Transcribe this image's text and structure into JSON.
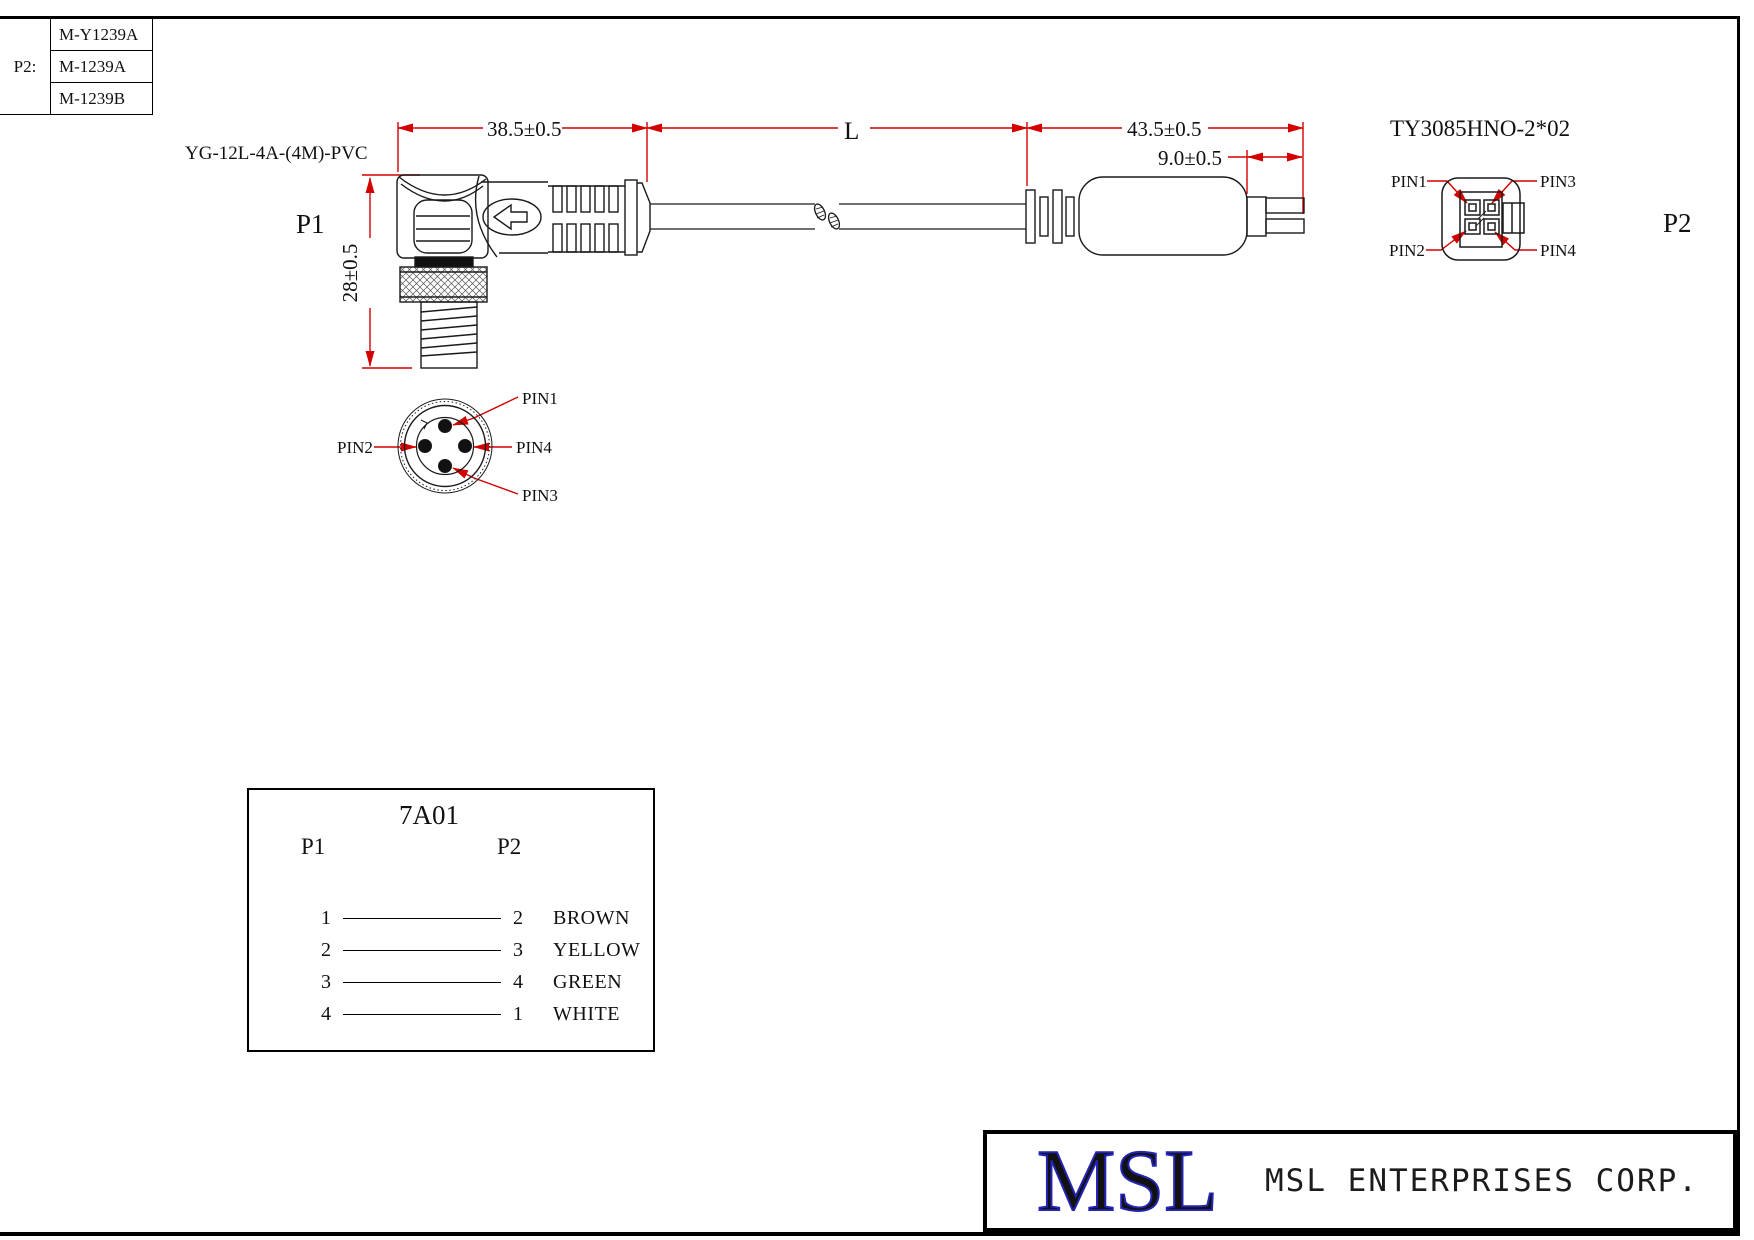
{
  "colors": {
    "line": "#1a1a1a",
    "dimension_red": "#d40000",
    "logo_blue": "#2323b4"
  },
  "variants_table": {
    "row_label": "P2:",
    "models": [
      {
        "name": "M-Y1239A"
      },
      {
        "name": "M-1239A"
      },
      {
        "name": "M-1239B"
      }
    ]
  },
  "drawing": {
    "cable_label": "YG-12L-4A-(4M)-PVC",
    "p1_label": "P1",
    "p2_label": "P2",
    "p2_connector_title": "TY3085HNO-2*02",
    "dims": {
      "p1_body_length": "38.5±0.5",
      "cable_length": "L",
      "p2_length": "43.5±0.5",
      "p2_tab": "9.0±0.5",
      "p1_height": "28±0.5"
    },
    "p1_face_pins": {
      "top": "PIN1",
      "left": "PIN2",
      "right": "PIN4",
      "bottom": "PIN3"
    },
    "p2_face_pins": {
      "top_left": "PIN1",
      "top_right": "PIN3",
      "bottom_left": "PIN2",
      "bottom_right": "PIN4"
    }
  },
  "wiring": {
    "title": "7A01",
    "col1": "P1",
    "col2": "P2",
    "rows": [
      {
        "p1": "1",
        "p2": "2",
        "color": "BROWN"
      },
      {
        "p1": "2",
        "p2": "3",
        "color": "YELLOW"
      },
      {
        "p1": "3",
        "p2": "4",
        "color": "GREEN"
      },
      {
        "p1": "4",
        "p2": "1",
        "color": "WHITE"
      }
    ]
  },
  "title_block": {
    "logo": "MSL",
    "company": "MSL ENTERPRISES CORP."
  }
}
